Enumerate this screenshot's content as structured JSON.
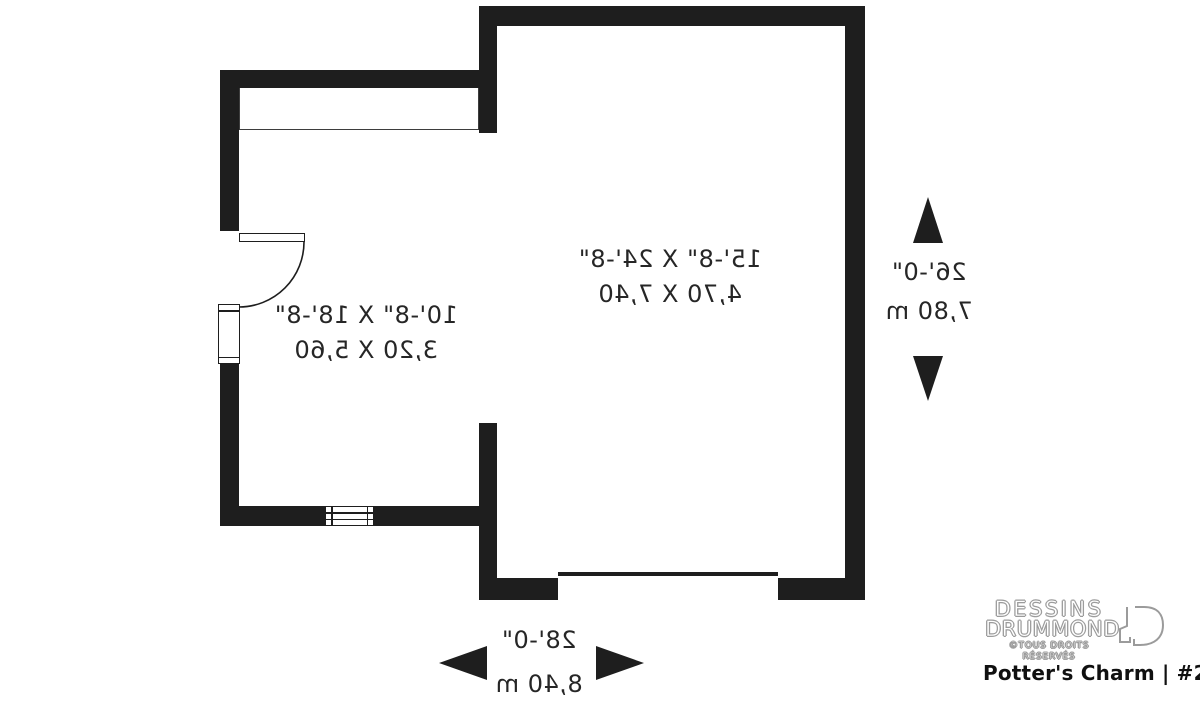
{
  "plan": {
    "garage": {
      "imperial": "15'-8\" X 24'-8\"",
      "metric": "4,70 X 7,40"
    },
    "storage": {
      "imperial": "10'-8\" X 18'-8\"",
      "metric": "3,20 X 5,60"
    },
    "dim_vertical": {
      "imperial": "26'-0\"",
      "metric": "7,80 m"
    },
    "dim_horizontal": {
      "imperial": "28'-0\"",
      "metric": "8,40 m"
    }
  },
  "branding": {
    "name_line1": "DESSINS",
    "name_line2": "DRUMMOND",
    "copyright": "©TOUS DROITS RÉSERVÉS",
    "plan_title": "Potter's Charm | #2983"
  },
  "icons": {
    "dimension_arrows": [
      "dim-arrow-up-icon",
      "dim-arrow-down-icon",
      "dim-arrow-left-icon",
      "dim-arrow-right-icon"
    ],
    "logo_icon": "drummond-door-icon",
    "door_symbol": "door-swing-symbol",
    "window_symbol": "window-symbol",
    "vent_symbol": "louvered-vent-symbol"
  },
  "colors": {
    "wall": "#1e1e1e",
    "label_text": "#262626",
    "logo_outline": "#9b9b9b",
    "title_text": "#101010",
    "background": "#ffffff"
  }
}
